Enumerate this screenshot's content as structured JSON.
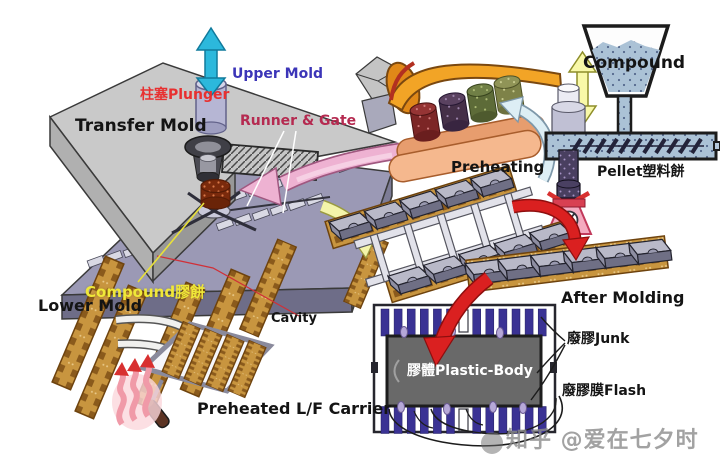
{
  "labels": {
    "transfer_mold": "Transfer Mold",
    "upper_mold": "Upper Mold",
    "plunger": "柱塞Plunger",
    "runner_gate": "Runner & Gate",
    "compound_cake": "Compound膠餅",
    "lower_mold": "Lower Mold",
    "cavity": "Cavity",
    "preheated_carrier": "Preheated L/F Carrier",
    "preheating": "Preheating",
    "compound": "Compound",
    "pellet": "Pellet塑料餅",
    "after_molding": "After Molding",
    "junk": "廢膠Junk",
    "flash": "廢膠膜Flash",
    "plastic_body": "膠體Plastic-Body",
    "watermark": "知乎 @爱在七夕时"
  },
  "colors": {
    "label_dark": "#141414",
    "upper_mold_text": "#3c35b8",
    "plunger_text": "#e83030",
    "runner_gate_text": "#b52a50",
    "compound_cake_text": "#f0e838",
    "plastic_body_text": "#ffffff",
    "watermark_text": "#8c8c8c",
    "arrow_cyan": "#2cb8dc",
    "arrow_pink": "#eeb2d2",
    "arrow_yellow": "#f4f4aa",
    "arrow_red": "#da2020",
    "arrow_blue_white": "#ddeef5",
    "mold_gray": "#c9c9c9",
    "plate_purple": "#9b99b5",
    "leadframe_gold": "#c8953f",
    "lead_indigo": "#3a3294",
    "body_gray": "#696969",
    "preheat_orange": "#f2a426",
    "roller_salmon": "#f5b88e",
    "compound_blue": "#abc2d6",
    "scale_pink": "#f4aabf"
  }
}
